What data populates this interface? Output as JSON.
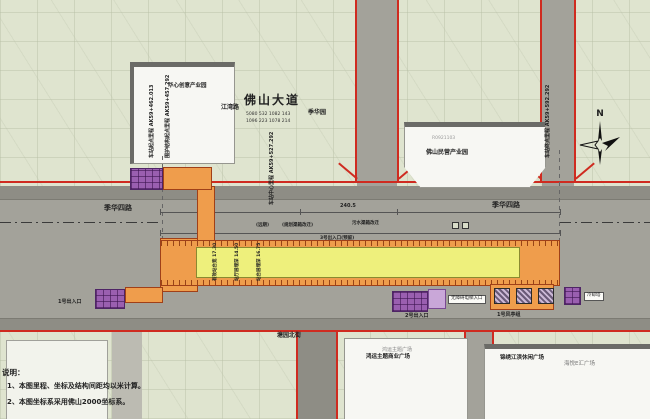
{
  "roads": {
    "jihua_left": "季华四路",
    "jihua_right": "季华四路",
    "foshan_avenue": "佛山大道",
    "jiangwan": "江湾路",
    "jihua_park": "季华园",
    "stakes_row1": "5080 532 1082 143",
    "stakes_row2": "1096 223 1078 214",
    "tangyuan_north": "塘园北街"
  },
  "mileage": {
    "start_line1": "车站起点里程 AK59+462.013",
    "start_line2": "围护结构起点里程 AK59+457.292",
    "center": "车站中心里程 AK59+527.292",
    "end": "车站终点里程 AK59+592.292"
  },
  "buildings": {
    "top_left": "华心创意产业园",
    "top_center_sub": "R0921103",
    "top_center": "佛山民营产业园",
    "bottom_center_sub": "鸿运主题广场",
    "bottom_center": "鸿运主题商业广场",
    "bottom_right_main": "锦绣江滨休闲广场",
    "bottom_right_sub": "海悦E汇广场"
  },
  "station": {
    "labels": [
      "有效站台宽 17.30",
      "站厅层埋深 14.50",
      "站台层埋深 16.75"
    ],
    "dim_top": "240.5",
    "ann_farterm": "(远期)",
    "ann_channel": "(规划渠箱改迁)",
    "ann_exit3": "3号出入口(预留)",
    "ann_sewer": "污水渠箱改迁",
    "exit1": "1号出入口",
    "exit2": "2号出入口",
    "barrier_free": "无障碍电梯入口",
    "vent1": "1号风亭组",
    "cooling": "冷却塔"
  },
  "notes": {
    "heading": "说明：",
    "line1": "1、本图里程、坐标及结构间距均以米计算。",
    "line2": "2、本图坐标系采用佛山2000坐标系。"
  },
  "compass": {
    "n": "N"
  },
  "colors": {
    "station_orange": "#ef9d4c",
    "platform_yellow": "#eef07c",
    "entrance_purple": "#9a5fb0",
    "boundary_red": "#cf2b20",
    "road_gray": "#a3a29a",
    "map_green": "#dfe4cf"
  }
}
